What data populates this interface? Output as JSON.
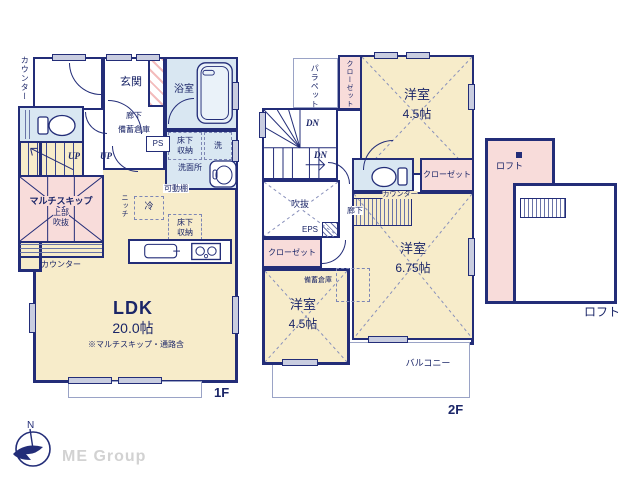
{
  "colors": {
    "wall": "#232d78",
    "room_cream": "#f7ecca",
    "room_pink": "#f8dcda",
    "room_blue": "#d9e7f2",
    "window_gray": "#c9cde0",
    "text_navy": "#1b2668",
    "logo_gray": "#d2d2d2"
  },
  "f1": {
    "floor_label": "1F",
    "counter_side": "カウンター",
    "genkan": "玄関",
    "bath": "浴室",
    "hall": "廊下",
    "storage": "備蓄倉庫",
    "ps": "PS",
    "underfloor_1": "床下",
    "underfloor_2": "収納",
    "washer": "洗",
    "washroom": "洗面所",
    "shelf": "可動棚",
    "up_a": "UP",
    "up_b": "UP",
    "multiskip": "マルチスキップ",
    "multiskip_sub1": "上部",
    "multiskip_sub2": "吹抜",
    "counter_bottom": "カウンター",
    "niche": "ニッチ",
    "fridge": "冷",
    "kitchen_uf_1": "床下",
    "kitchen_uf_2": "収納",
    "ldk": "LDK",
    "ldk_size": "20.0帖",
    "ldk_note": "※マルチスキップ・通路含"
  },
  "f2": {
    "floor_label": "2F",
    "parapet": "パラペット",
    "closet_top": "クローゼット",
    "room_top": "洋室",
    "room_top_size": "4.5帖",
    "dn_a": "DN",
    "dn_b": "DN",
    "void": "吹抜",
    "hall": "廊下",
    "eps": "EPS",
    "counter": "カウンター",
    "closet_right": "クローゼット",
    "closet_left": "クローゼット",
    "storage": "備蓄倉庫",
    "room_right": "洋室",
    "room_right_size": "6.75帖",
    "room_bottom": "洋室",
    "room_bottom_size": "4.5帖",
    "balcony": "バルコニー"
  },
  "loft": {
    "label_inside": "ロフト",
    "label_outside": "ロフト"
  },
  "footer": {
    "brand": "ME Group",
    "compass_n": "N"
  }
}
